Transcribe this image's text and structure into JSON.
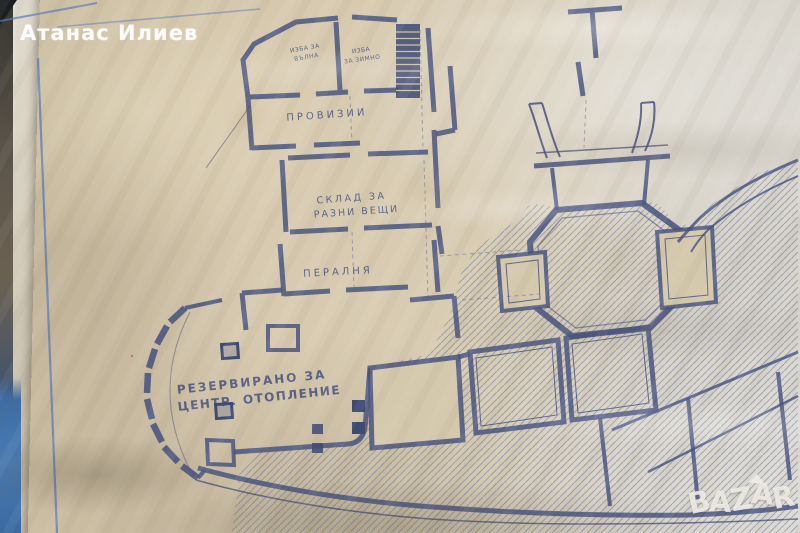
{
  "watermark": {
    "text": "Атанас Илиев"
  },
  "logo": {
    "letters": [
      "B",
      "A",
      "Z",
      "A",
      "R"
    ]
  },
  "plan": {
    "labels": {
      "cellar1_line1": "ИЗБА ЗА",
      "cellar1_line2": "ВЪЛНА",
      "cellar2_line1": "ИЗБА",
      "cellar2_line2": "ЗА ЗИМНО",
      "provisions": "ПРОВИЗИИ",
      "storage_line1": "СКЛАД ЗА",
      "storage_line2": "РАЗНИ ВЕЩИ",
      "laundry": "ПЕРАЛНЯ",
      "reserved_line1": "РЕЗЕРВИРАНО ЗА",
      "reserved_line2": "ЦЕНТР. ОТОПЛЕНИЕ"
    },
    "colors": {
      "ink": "#44507e",
      "paper": "#d5c9ae",
      "hatch": "#6b7799",
      "border_blue": "#5b79b8",
      "cover_blue": "#3c6ea7"
    }
  }
}
